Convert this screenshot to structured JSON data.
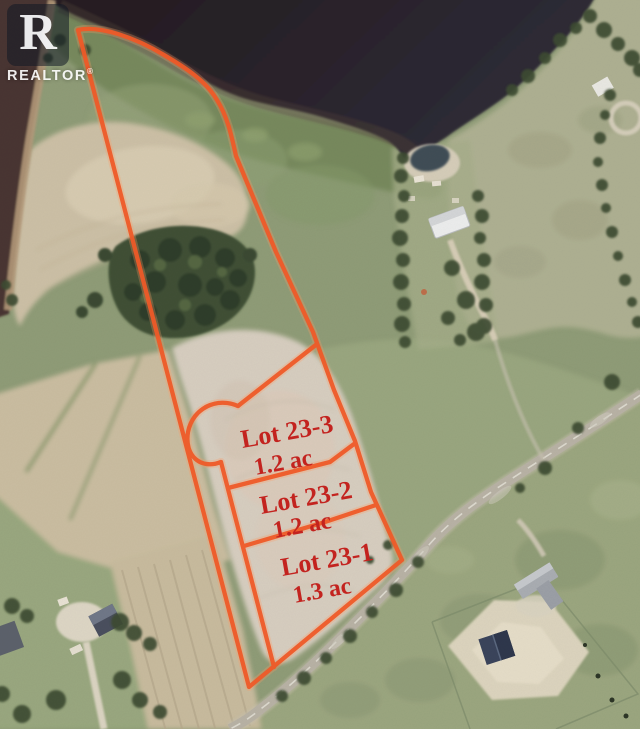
{
  "watermark": {
    "letter": "R",
    "label": "REALTOR",
    "registered": "®"
  },
  "lots": [
    {
      "name": "Lot 23-3",
      "area": "1.2 ac"
    },
    {
      "name": "Lot 23-2",
      "area": "1.2 ac"
    },
    {
      "name": "Lot 23-1",
      "area": "1.3 ac"
    }
  ],
  "colors": {
    "boundary_orange": "#ee5a28",
    "label_red": "#c3231f",
    "water_dark": "#261e22",
    "field_tan": "#ccc0a6",
    "forest_green": "#3f5036",
    "road_gray": "#b8b2a5"
  }
}
